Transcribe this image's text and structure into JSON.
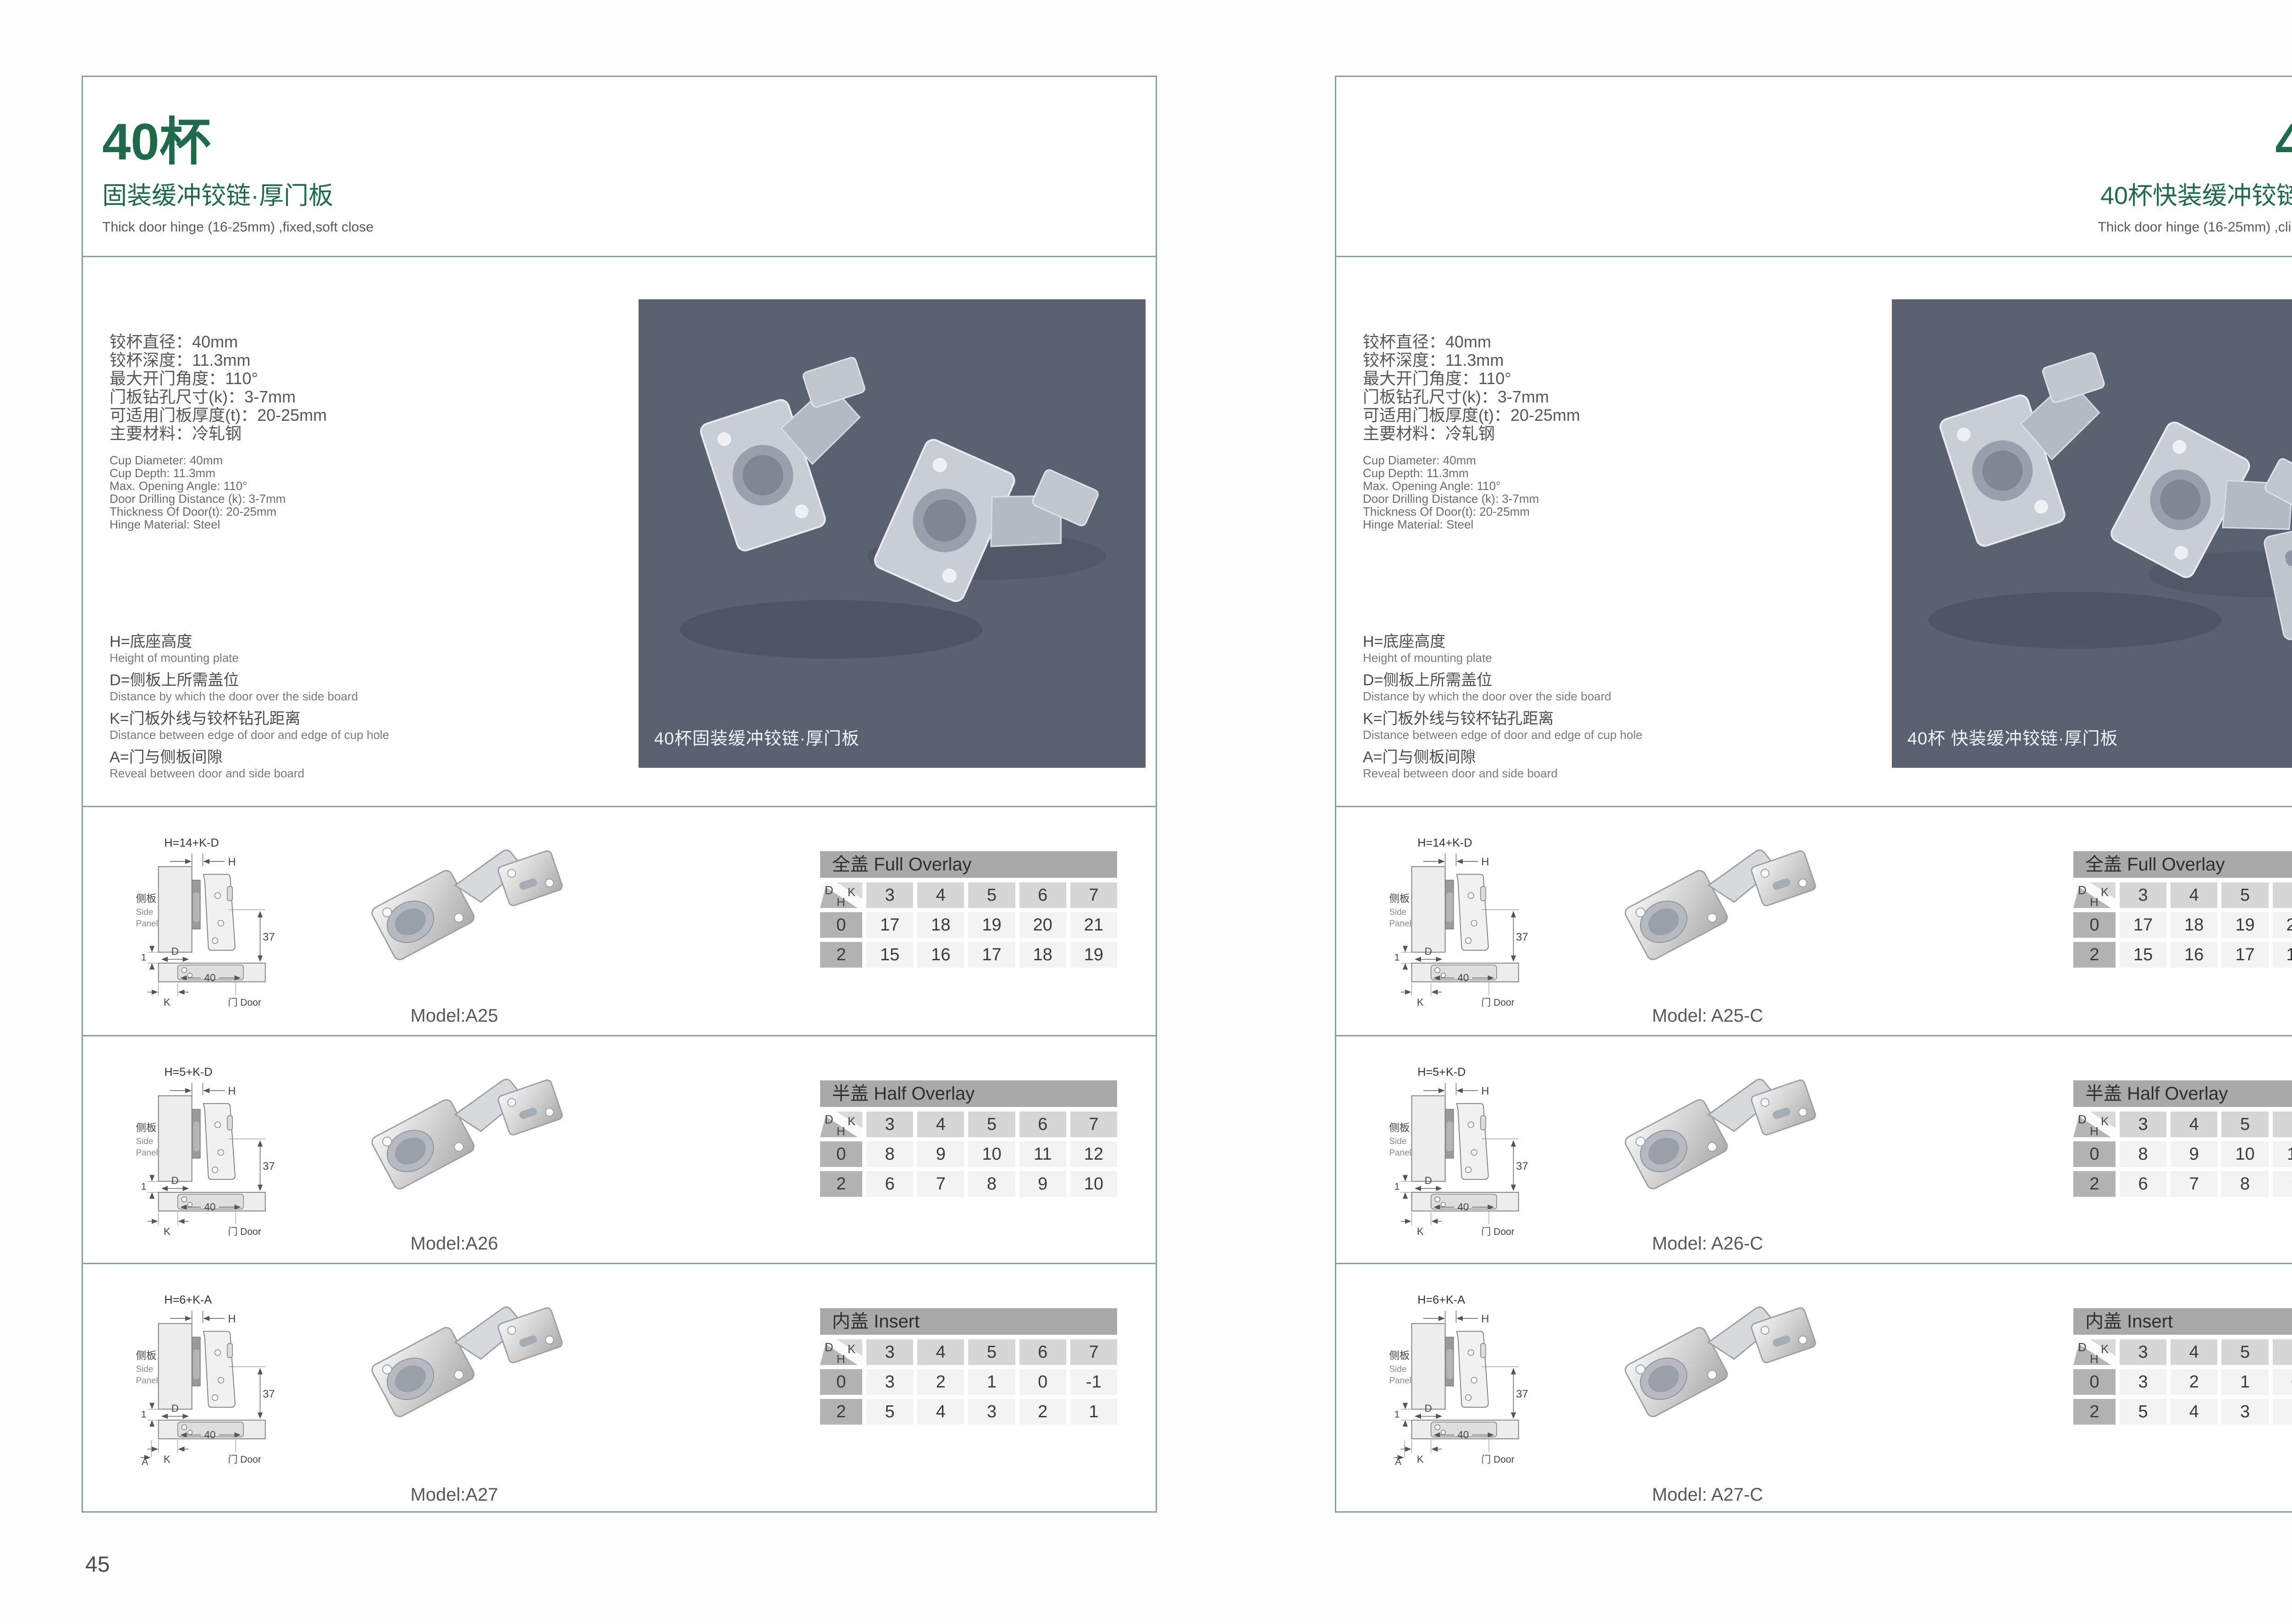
{
  "shared": {
    "dims": {
      "h": "H",
      "d": "D",
      "k": "K",
      "a": "A",
      "one": "1",
      "thirty_seven": "37",
      "forty": "40"
    },
    "corner": {
      "d": "D",
      "k": "K",
      "h": "H"
    },
    "side_panel_cn": "侧板",
    "side_panel_en_1": "Side",
    "side_panel_en_2": "Panel",
    "door_label": "门 Door"
  },
  "left": {
    "page_number": "45",
    "title": "40杯",
    "subtitle": "固装缓冲铰链·厚门板",
    "tagline": "Thick door hinge (16-25mm)  ,fixed,soft close",
    "specs_cn": [
      "铰杯直径：40mm",
      "铰杯深度：11.3mm",
      "最大开门角度：110°",
      "门板钻孔尺寸(k)：3-7mm",
      "可适用门板厚度(t)：20-25mm",
      "主要材料：冷轧钢"
    ],
    "specs_en": [
      "Cup Diameter: 40mm",
      "Cup Depth: 11.3mm",
      "Max. Opening Angle: 110°",
      "Door Drilling Distance (k): 3-7mm",
      "Thickness Of Door(t): 20-25mm",
      "Hinge Material: Steel"
    ],
    "legend": [
      {
        "cn": "H=底座高度",
        "en": "Height of mounting plate"
      },
      {
        "cn": "D=侧板上所需盖位",
        "en": "Distance by which the door over the side board"
      },
      {
        "cn": "K=门板外线与铰杯钻孔距离",
        "en": "Distance between edge of door and edge of cup hole"
      },
      {
        "cn": "A=门与侧板间隙",
        "en": "Reveal between door and side board"
      }
    ],
    "photo_caption": "40杯固装缓冲铰链·厚门板",
    "rows": [
      {
        "formula": "H=14+K-D",
        "model": "Model:A25",
        "table": {
          "title": "全盖 Full Overlay",
          "k": [
            "3",
            "4",
            "5",
            "6",
            "7"
          ],
          "h_rows": [
            {
              "h": "0",
              "v": [
                "17",
                "18",
                "19",
                "20",
                "21"
              ]
            },
            {
              "h": "2",
              "v": [
                "15",
                "16",
                "17",
                "18",
                "19"
              ]
            }
          ]
        }
      },
      {
        "formula": "H=5+K-D",
        "model": "Model:A26",
        "table": {
          "title": "半盖 Half Overlay",
          "k": [
            "3",
            "4",
            "5",
            "6",
            "7"
          ],
          "h_rows": [
            {
              "h": "0",
              "v": [
                "8",
                "9",
                "10",
                "11",
                "12"
              ]
            },
            {
              "h": "2",
              "v": [
                "6",
                "7",
                "8",
                "9",
                "10"
              ]
            }
          ]
        }
      },
      {
        "formula": "H=6+K-A",
        "model": "Model:A27",
        "table": {
          "title": "内盖 Insert",
          "k": [
            "3",
            "4",
            "5",
            "6",
            "7"
          ],
          "h_rows": [
            {
              "h": "0",
              "v": [
                "3",
                "2",
                "1",
                "0",
                "-1"
              ]
            },
            {
              "h": "2",
              "v": [
                "5",
                "4",
                "3",
                "2",
                "1"
              ]
            }
          ]
        }
      }
    ]
  },
  "right": {
    "page_number": "46",
    "title": "40杯",
    "subtitle": "40杯快装缓冲铰链·厚门板",
    "tagline": "Thick door hinge (16-25mm)  ,clip on ,soft close",
    "specs_cn": [
      "铰杯直径：40mm",
      "铰杯深度：11.3mm",
      "最大开门角度：110°",
      "门板钻孔尺寸(k)：3-7mm",
      "可适用门板厚度(t)：20-25mm",
      "主要材料：冷轧钢"
    ],
    "specs_en": [
      "Cup Diameter: 40mm",
      "Cup Depth: 11.3mm",
      "Max. Opening Angle: 110°",
      "Door Drilling Distance (k): 3-7mm",
      "Thickness Of Door(t): 20-25mm",
      "Hinge Material: Steel"
    ],
    "legend": [
      {
        "cn": "H=底座高度",
        "en": "Height of mounting plate"
      },
      {
        "cn": "D=侧板上所需盖位",
        "en": "Distance by which the door over the side board"
      },
      {
        "cn": "K=门板外线与铰杯钻孔距离",
        "en": "Distance between edge of door and edge of cup hole"
      },
      {
        "cn": "A=门与侧板间隙",
        "en": "Reveal between door and side board"
      }
    ],
    "photo_caption": "40杯 快装缓冲铰链·厚门板",
    "rows": [
      {
        "formula": "H=14+K-D",
        "model": "Model: A25-C",
        "table": {
          "title": "全盖 Full Overlay",
          "k": [
            "3",
            "4",
            "5",
            "6",
            "7"
          ],
          "h_rows": [
            {
              "h": "0",
              "v": [
                "17",
                "18",
                "19",
                "20",
                "21"
              ]
            },
            {
              "h": "2",
              "v": [
                "15",
                "16",
                "17",
                "18",
                "19"
              ]
            }
          ]
        }
      },
      {
        "formula": "H=5+K-D",
        "model": "Model: A26-C",
        "table": {
          "title": "半盖 Half Overlay",
          "k": [
            "3",
            "4",
            "5",
            "6",
            "7"
          ],
          "h_rows": [
            {
              "h": "0",
              "v": [
                "8",
                "9",
                "10",
                "11",
                "12"
              ]
            },
            {
              "h": "2",
              "v": [
                "6",
                "7",
                "8",
                "9",
                "10"
              ]
            }
          ]
        }
      },
      {
        "formula": "H=6+K-A",
        "model": "Model: A27-C",
        "table": {
          "title": "内盖 Insert",
          "k": [
            "3",
            "4",
            "5",
            "6",
            "7"
          ],
          "h_rows": [
            {
              "h": "0",
              "v": [
                "3",
                "2",
                "1",
                "0",
                "-1"
              ]
            },
            {
              "h": "2",
              "v": [
                "5",
                "4",
                "3",
                "2",
                "1"
              ]
            }
          ]
        }
      }
    ]
  }
}
